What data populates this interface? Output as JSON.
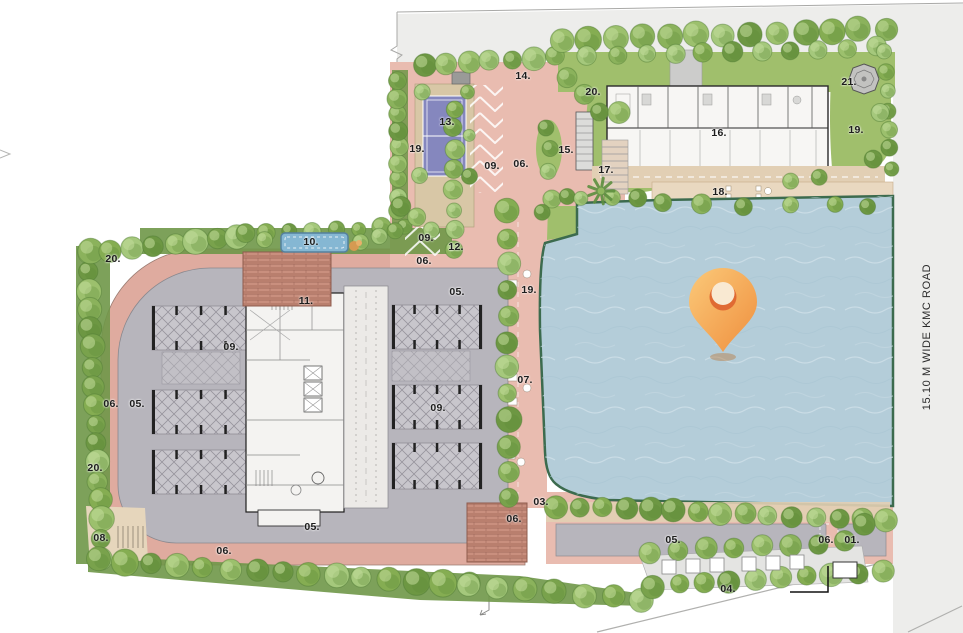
{
  "road": {
    "label": "15.10 M WIDE KMC ROAD"
  },
  "marker": {
    "name": "location-pin"
  },
  "palette": {
    "paving_pink": "#dfab9f",
    "paving_pink_light": "#e9bcb0",
    "podium_gray": "#b7b5bc",
    "stall_gray": "#c8c6cc",
    "core_white": "#f4f3f1",
    "lane_gray": "#eceae7",
    "brick": "#c08575",
    "brick_light": "#d49c8b",
    "lake_blue": "#b4cdd9",
    "lake_rim": "#3c6b4e",
    "lawn_green": "#a0bf6c",
    "hedge_green": "#6f9748",
    "tan_path": "#e2cfb4",
    "deck_tan": "#e9d8c0",
    "court_purple": "#8587be",
    "court_base": "#d8c7a6",
    "pool_blue": "#85b7d3",
    "road_gray": "#ededeb",
    "pin_orange_light": "#fbc878",
    "pin_orange_dark": "#ef8f3e",
    "pin_deep_orange": "#e06a33",
    "tree_greens": [
      "#79a24c",
      "#8bb25c",
      "#9cc06d",
      "#6d9743",
      "#85ad52",
      "#a5c87c"
    ]
  },
  "plan_labels": [
    {
      "text": "01.",
      "x": 852,
      "y": 540
    },
    {
      "text": "03.",
      "x": 541,
      "y": 502
    },
    {
      "text": "04.",
      "x": 728,
      "y": 589
    },
    {
      "text": "05.",
      "x": 457,
      "y": 292
    },
    {
      "text": "05.",
      "x": 137,
      "y": 404
    },
    {
      "text": "05.",
      "x": 312,
      "y": 527
    },
    {
      "text": "05.",
      "x": 673,
      "y": 540
    },
    {
      "text": "06.",
      "x": 521,
      "y": 164
    },
    {
      "text": "06.",
      "x": 424,
      "y": 261
    },
    {
      "text": "06.",
      "x": 111,
      "y": 404
    },
    {
      "text": "06.",
      "x": 514,
      "y": 519
    },
    {
      "text": "06.",
      "x": 224,
      "y": 551
    },
    {
      "text": "06.",
      "x": 826,
      "y": 540
    },
    {
      "text": "07.",
      "x": 525,
      "y": 380
    },
    {
      "text": "08.",
      "x": 101,
      "y": 538
    },
    {
      "text": "09.",
      "x": 492,
      "y": 166
    },
    {
      "text": "09.",
      "x": 426,
      "y": 238
    },
    {
      "text": "09.",
      "x": 231,
      "y": 347
    },
    {
      "text": "09.",
      "x": 438,
      "y": 408
    },
    {
      "text": "10.",
      "x": 311,
      "y": 242
    },
    {
      "text": "11.",
      "x": 306,
      "y": 301
    },
    {
      "text": "12.",
      "x": 456,
      "y": 247
    },
    {
      "text": "13.",
      "x": 447,
      "y": 122
    },
    {
      "text": "14.",
      "x": 523,
      "y": 76
    },
    {
      "text": "15.",
      "x": 566,
      "y": 150
    },
    {
      "text": "16.",
      "x": 719,
      "y": 133
    },
    {
      "text": "17.",
      "x": 606,
      "y": 170
    },
    {
      "text": "18.",
      "x": 720,
      "y": 192
    },
    {
      "text": "19.",
      "x": 417,
      "y": 149
    },
    {
      "text": "19.",
      "x": 856,
      "y": 130
    },
    {
      "text": "19.",
      "x": 529,
      "y": 290
    },
    {
      "text": "20.",
      "x": 593,
      "y": 92
    },
    {
      "text": "20.",
      "x": 113,
      "y": 259
    },
    {
      "text": "20.",
      "x": 95,
      "y": 468
    },
    {
      "text": "21.",
      "x": 849,
      "y": 82
    }
  ]
}
